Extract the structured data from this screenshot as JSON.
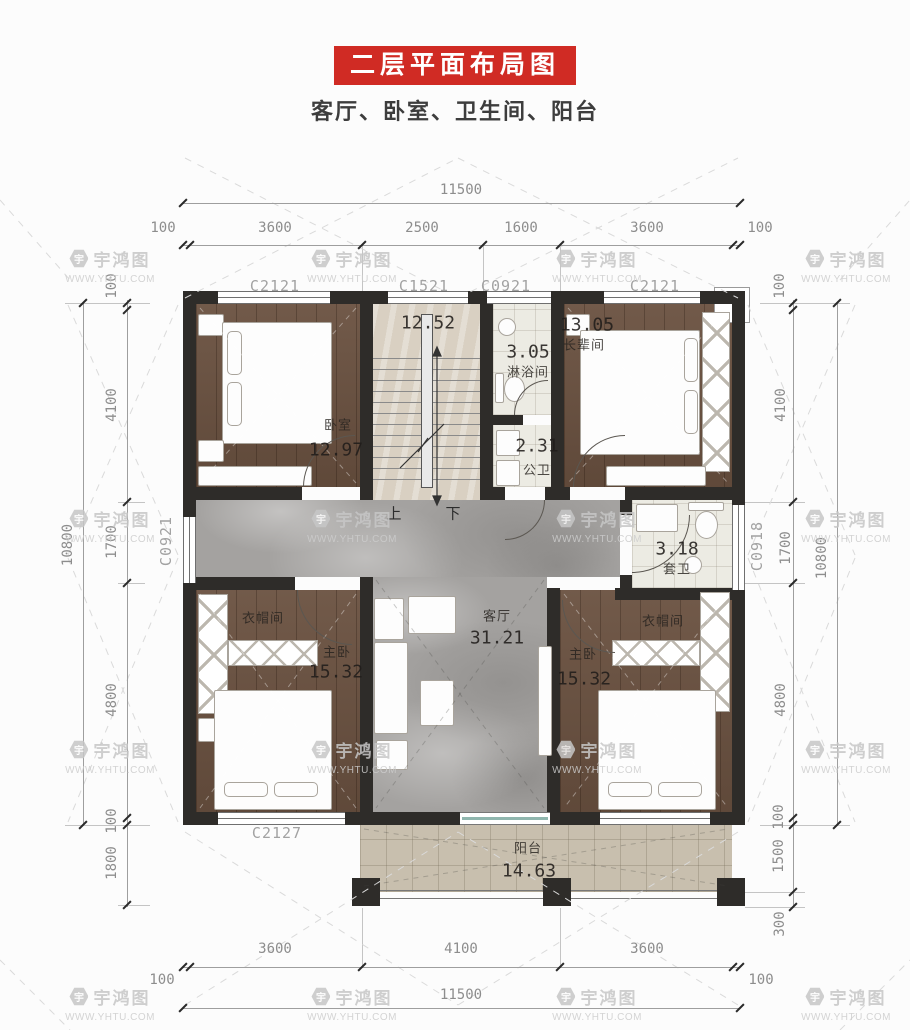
{
  "title": {
    "banner": "二层平面布局图",
    "subtitle": "客厅、卧室、卫生间、阳台"
  },
  "watermark": {
    "brand": "宇鸿图",
    "url": "WWW.YHTU.COM",
    "logo_char": "宇"
  },
  "dimensions": {
    "top": {
      "overall": "11500",
      "segments": [
        "100",
        "3600",
        "2500",
        "1600",
        "3600",
        "100"
      ]
    },
    "bottom": {
      "overall": "11500",
      "segments": [
        "100",
        "3600",
        "4100",
        "3600",
        "100"
      ]
    },
    "left": {
      "overall": "10800",
      "segments": [
        "100",
        "4100",
        "1700",
        "4800",
        "100",
        "1800"
      ]
    },
    "right": {
      "overall": "10800",
      "segments": [
        "100",
        "4100",
        "1700",
        "4800",
        "100",
        "1500",
        "300"
      ]
    }
  },
  "windows": {
    "top": [
      "C2121",
      "C1521",
      "C0921",
      "C2121"
    ],
    "left": "C0921",
    "right": "C0918",
    "bottom": "C2127"
  },
  "rooms": {
    "bedroom_nw": {
      "name": "卧室",
      "area": "12.97"
    },
    "stairwell": {
      "area": "12.52"
    },
    "shower": {
      "name": "淋浴间",
      "area": "3.05"
    },
    "toilet_public": {
      "name": "公卫",
      "area": "2.31"
    },
    "bedroom_elder": {
      "name": "长辈间",
      "area": "13.05"
    },
    "toilet_ensuite": {
      "name": "套卫",
      "area": "3.18"
    },
    "living": {
      "name": "客厅",
      "area": "31.21"
    },
    "closet_west": {
      "name": "衣帽间"
    },
    "closet_east": {
      "name": "衣帽间"
    },
    "master_west": {
      "name": "主卧",
      "area": "15.32"
    },
    "master_east": {
      "name": "主卧",
      "area": "15.32"
    },
    "balcony": {
      "name": "阳台",
      "area": "14.63"
    }
  },
  "stairs": {
    "up": "上",
    "down": "下"
  },
  "colors": {
    "banner_red": "#d02b24",
    "wall": "#2e2c29",
    "wood": "#6a5140",
    "marble": "#a4a2a0",
    "tile": "#ecebe3",
    "balcony_tile": "#c8bfae"
  }
}
